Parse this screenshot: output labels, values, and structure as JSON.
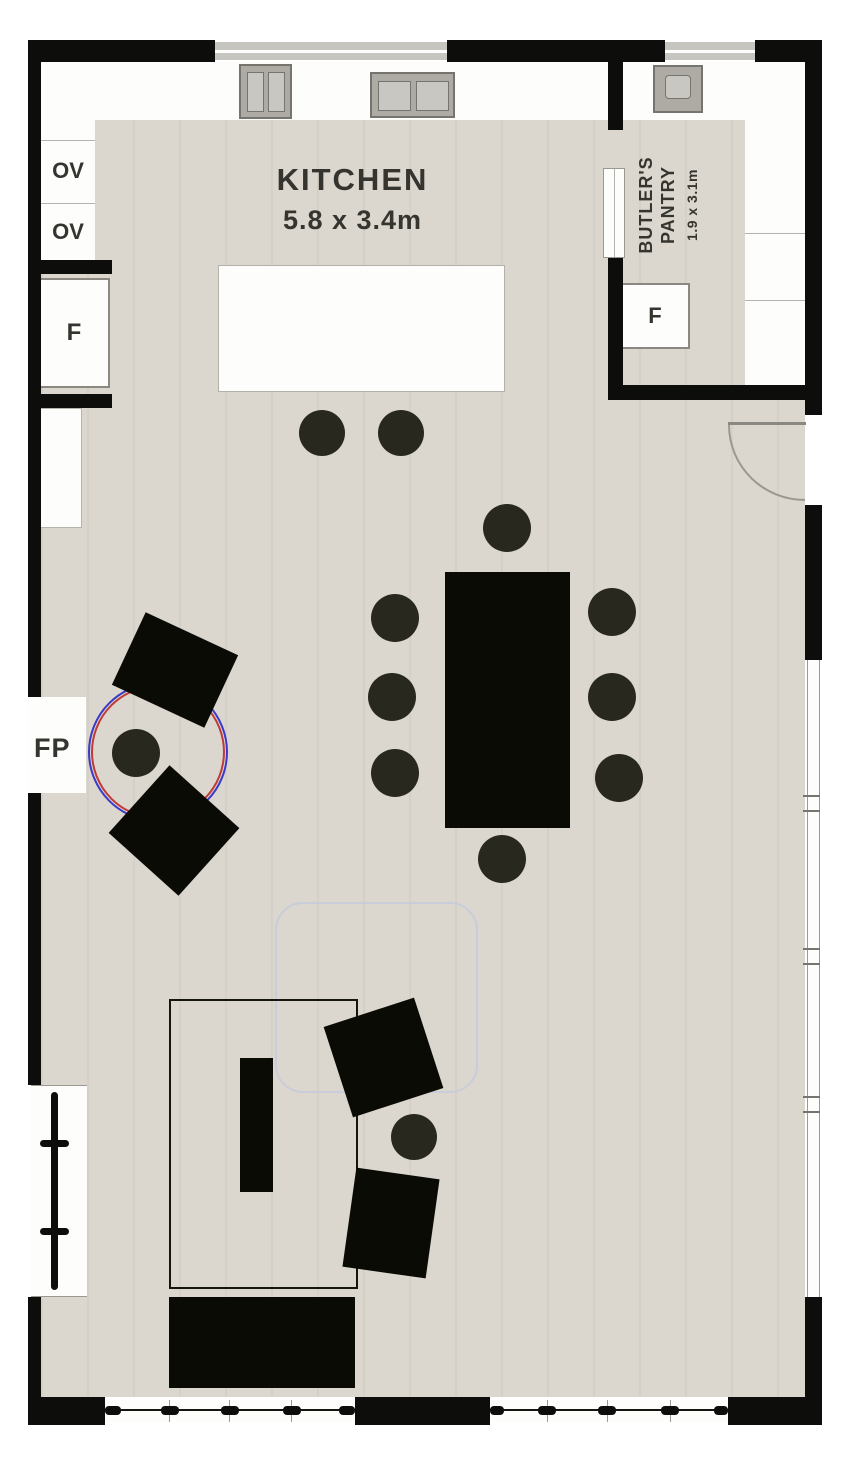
{
  "floorplan": {
    "rooms": [
      {
        "id": "kitchen",
        "name": "KITCHEN",
        "dimensions": "5.8 x 3.4m"
      },
      {
        "id": "butlers-pantry",
        "name": "BUTLER'S PANTRY",
        "dimensions": "1.9 x 3.1m"
      }
    ],
    "fixture_labels": {
      "oven_top": "OV",
      "oven_bottom": "OV",
      "fridge_kitchen": "F",
      "fridge_pantry": "F",
      "fireplace": "FP"
    },
    "furniture_counts": {
      "dining_chairs": 8,
      "island_stools": 2,
      "fireplace_armchairs": 2,
      "lounge_chairs": 2
    },
    "colors": {
      "wall": "#0d0d0b",
      "floor": "#dbd7ce",
      "counter": "#fdfdfc",
      "furniture": "#0b0b06",
      "fireplace_circle_outer": "#3a3ac8",
      "fireplace_circle_inner": "#c03a3a",
      "faint_outline": "#c3c8dd"
    }
  }
}
